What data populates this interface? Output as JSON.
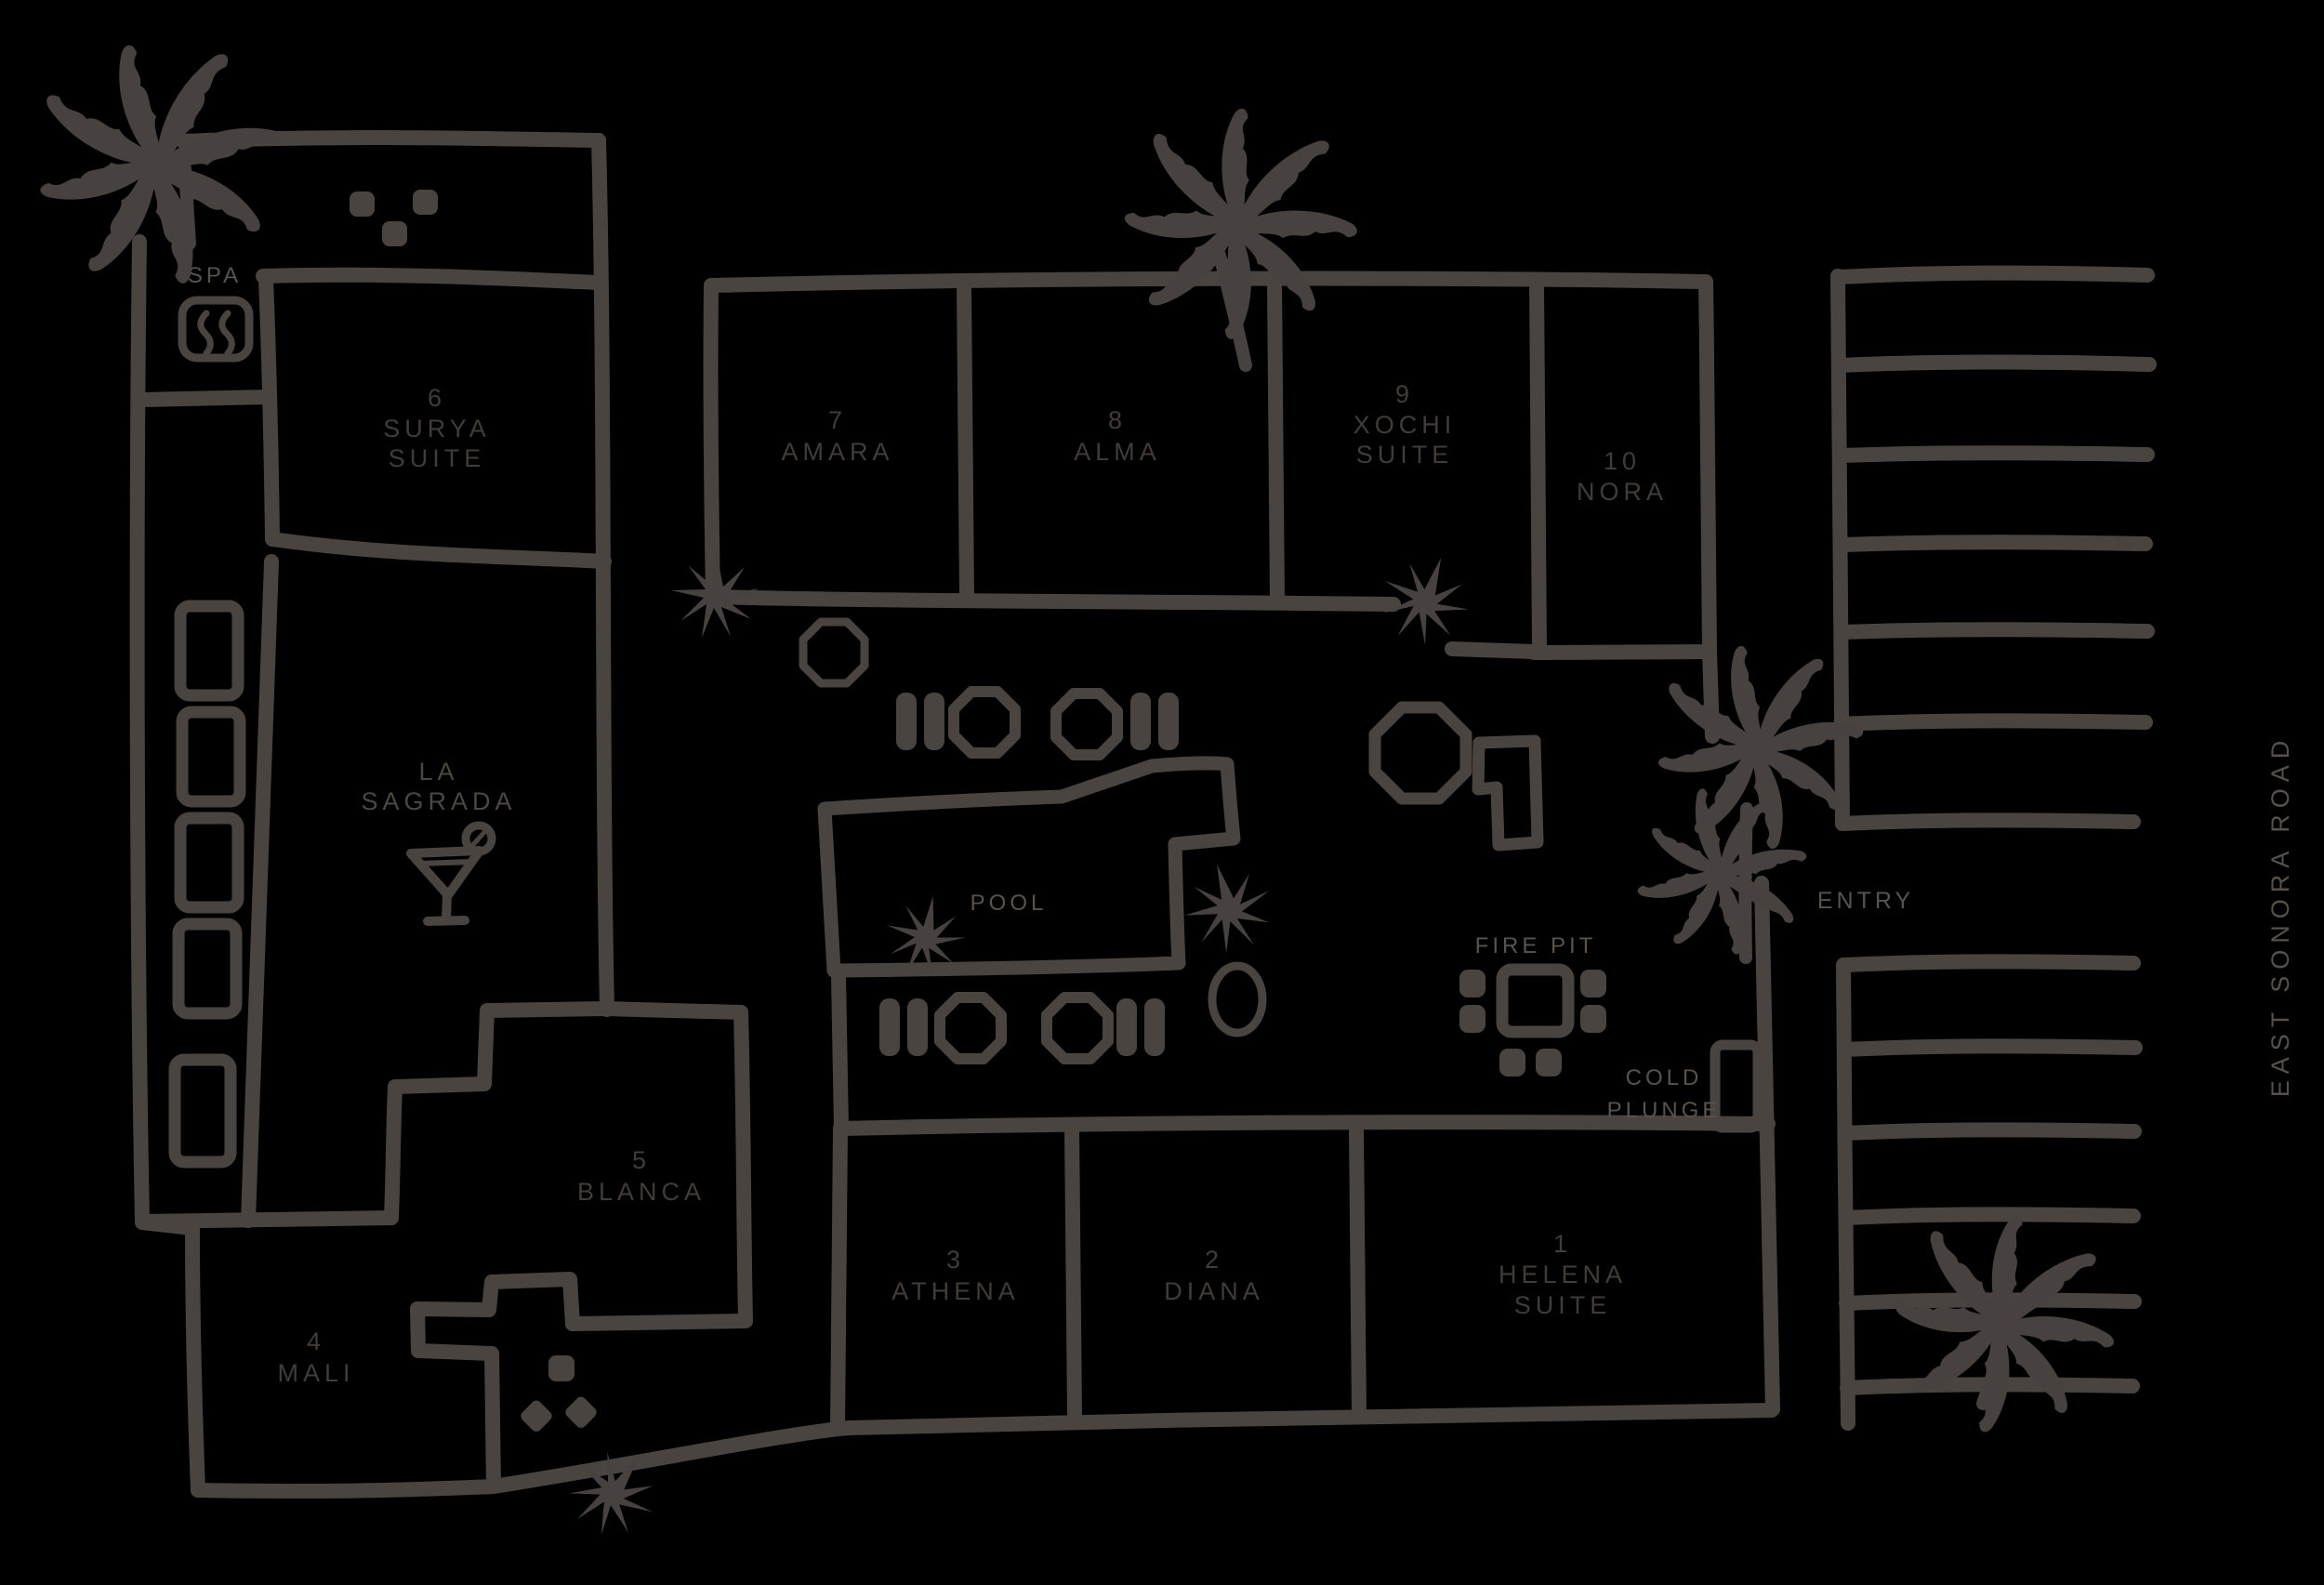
{
  "map_title": "resort site map",
  "colors": {
    "background": "#000000",
    "line": "#4a4440",
    "room_label": "#423c38",
    "amenity_label": "#5a534d"
  },
  "rooms": [
    {
      "number": "1",
      "name": "HELENA",
      "suffix": "SUITE"
    },
    {
      "number": "2",
      "name": "DIANA",
      "suffix": ""
    },
    {
      "number": "3",
      "name": "ATHENA",
      "suffix": ""
    },
    {
      "number": "4",
      "name": "MALI",
      "suffix": ""
    },
    {
      "number": "5",
      "name": "BLANCA",
      "suffix": ""
    },
    {
      "number": "6",
      "name": "SURYA",
      "suffix": "SUITE"
    },
    {
      "number": "7",
      "name": "AMARA",
      "suffix": ""
    },
    {
      "number": "8",
      "name": "ALMA",
      "suffix": ""
    },
    {
      "number": "9",
      "name": "XOCHI",
      "suffix": "SUITE"
    },
    {
      "number": "10",
      "name": "NORA",
      "suffix": ""
    }
  ],
  "amenities": {
    "spa": "SPA",
    "bar_line1": "LA",
    "bar_line2": "SAGRADA",
    "pool": "POOL",
    "fire_pit": "FIRE PIT",
    "cold_plunge_line1": "COLD",
    "cold_plunge_line2": "PLUNGE",
    "entry": "ENTRY",
    "road": "EAST SONORA ROAD"
  },
  "icons": {
    "spa": "steam-icon",
    "bar": "martini-glass-icon",
    "hot_tub": "hot-tub-icon",
    "fire_pit": "fire-pit-icon",
    "cold_plunge": "cold-plunge-icon",
    "vegetation": [
      "palm-tree-icon",
      "agave-icon"
    ],
    "furniture": [
      "lounge-chair-icon",
      "dining-table-icon",
      "stepping-stone-icon"
    ]
  }
}
